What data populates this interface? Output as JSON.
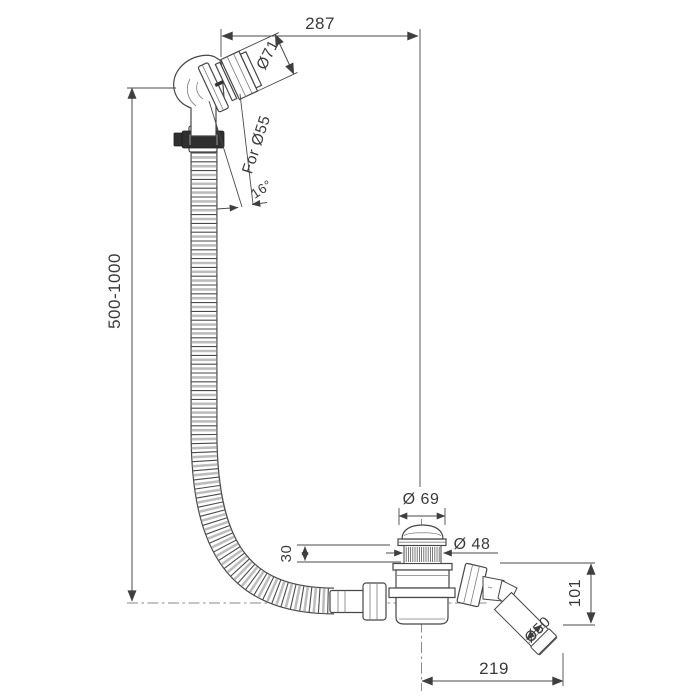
{
  "drawing": {
    "background": "#ffffff",
    "line_color": "#464646",
    "text_color": "#3a3a3a",
    "labels": {
      "width_top": "287",
      "hose_length_range": "500-1000",
      "overflow_diameter": "Ø71",
      "overflow_fit": "For Ø55",
      "overflow_angle": "16°",
      "cap_diameter": "Ø 69",
      "thread_diameter": "Ø 48",
      "collar_height": "30",
      "outlet_height": "101",
      "outlet_diameter": "Ø50",
      "width_bottom": "219"
    }
  }
}
